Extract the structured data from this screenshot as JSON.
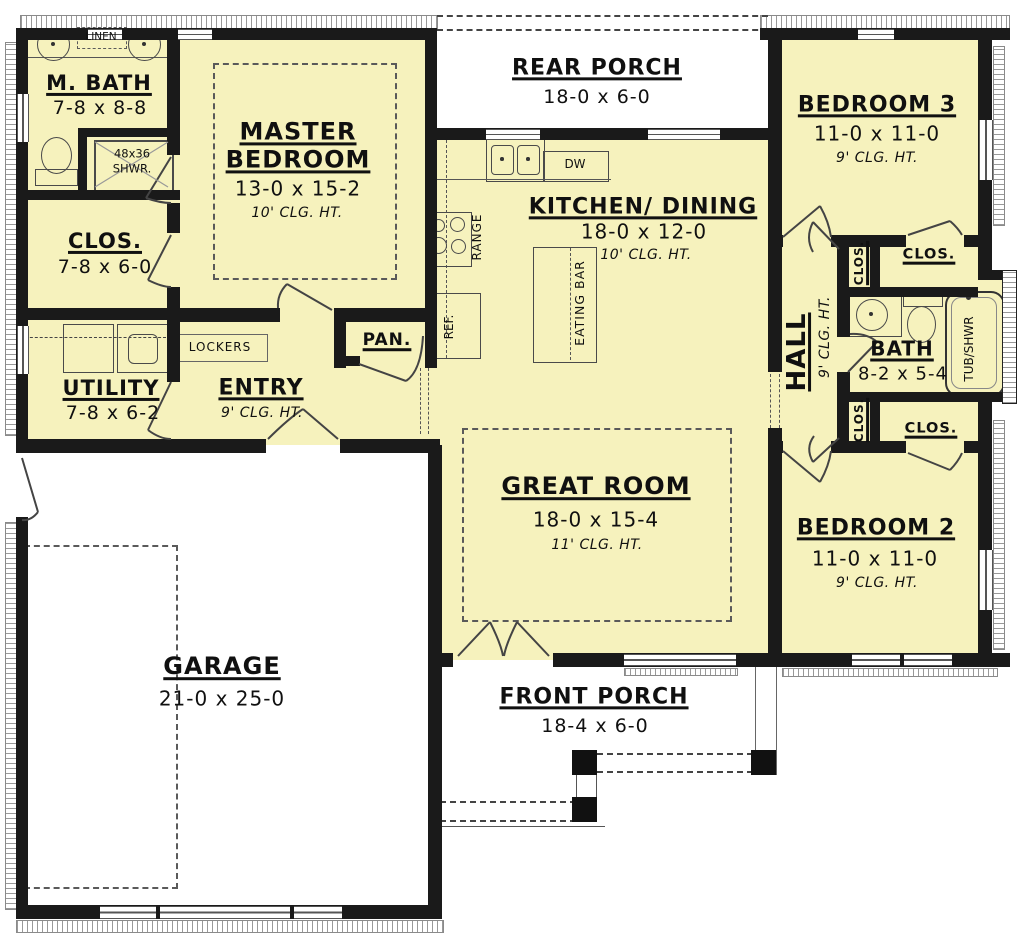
{
  "plan": {
    "colors": {
      "room_fill": "#f6f2bd",
      "wall": "#1a1a1a",
      "line": "#555555"
    },
    "rooms": {
      "m_bath": {
        "name": "M. BATH",
        "dims": "7-8 x 8-8"
      },
      "closet": {
        "name": "CLOS.",
        "dims": "7-8 x 6-0"
      },
      "utility": {
        "name": "UTILITY",
        "dims": "7-8 x 6-2"
      },
      "entry": {
        "name": "ENTRY",
        "ceiling": "9' CLG. HT."
      },
      "master_bedroom": {
        "name": "MASTER BEDROOM",
        "dims": "13-0 x 15-2",
        "ceiling": "10' CLG. HT."
      },
      "pantry": {
        "name": "PAN."
      },
      "rear_porch": {
        "name": "REAR PORCH",
        "dims": "18-0 x 6-0"
      },
      "kitchen_dining": {
        "name": "KITCHEN/ DINING",
        "dims": "18-0 x 12-0",
        "ceiling": "10' CLG. HT."
      },
      "great_room": {
        "name": "GREAT ROOM",
        "dims": "18-0 x 15-4",
        "ceiling": "11' CLG. HT."
      },
      "bedroom3": {
        "name": "BEDROOM 3",
        "dims": "11-0 x 11-0",
        "ceiling": "9' CLG. HT."
      },
      "hall": {
        "name": "HALL",
        "ceiling": "9' CLG. HT."
      },
      "bath": {
        "name": "BATH",
        "dims": "8-2 x 5-4"
      },
      "bedroom2": {
        "name": "BEDROOM 2",
        "dims": "11-0 x 11-0",
        "ceiling": "9' CLG. HT."
      },
      "garage": {
        "name": "GARAGE",
        "dims": "21-0 x 25-0"
      },
      "front_porch": {
        "name": "FRONT PORCH",
        "dims": "18-4 x 6-0"
      }
    },
    "fixtures": {
      "linen": "LINEN",
      "shower_line1": "48x36",
      "shower_line2": "SHWR.",
      "lockers": "LOCKERS",
      "dw": "DW",
      "range": "RANGE",
      "ref": "REF.",
      "eating_bar": "EATING BAR",
      "tub_shwr": "TUB/SHWR",
      "closet_top_small": "CLOS.",
      "closet_top": "CLOS.",
      "closet_bottom_small": "CLOS.",
      "closet_bottom": "CLOS."
    }
  }
}
